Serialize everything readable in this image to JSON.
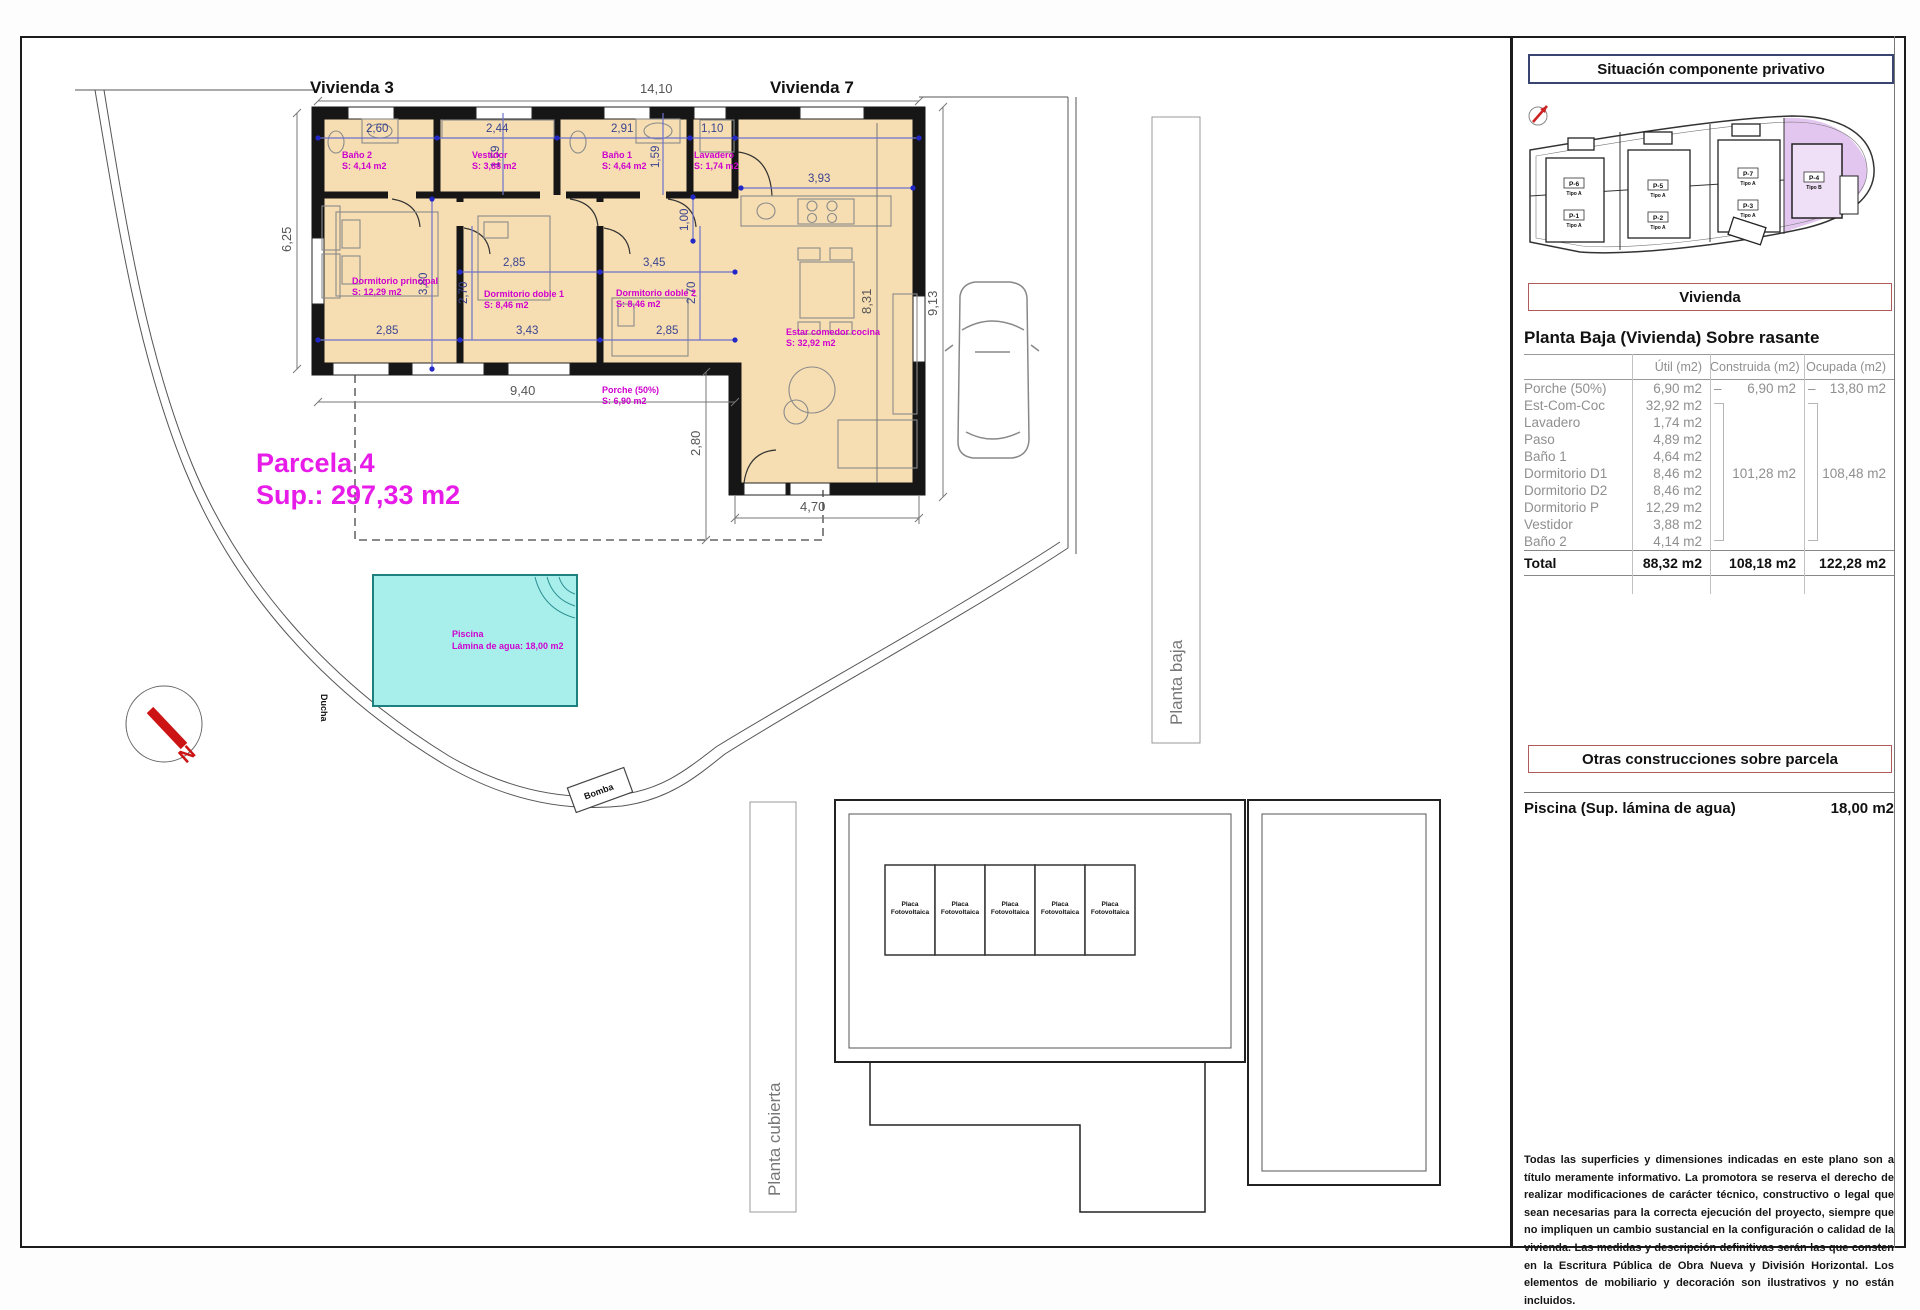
{
  "plan": {
    "labels": {
      "vivienda3": "Vivienda 3",
      "vivienda7": "Vivienda 7",
      "parcela": "Parcela 4",
      "parcela_sup": "Sup.: 297,33 m2",
      "piscina": "Piscina",
      "piscina_area": "Lámina de agua: 18,00 m2",
      "ducha": "Ducha",
      "bomba": "Bomba",
      "planta_baja": "Planta baja",
      "planta_cubierta": "Planta cubierta",
      "placa": "Placa",
      "fotovoltaica": "Fotovoltaica",
      "north": "N"
    },
    "rooms": [
      {
        "name": "Baño 2",
        "area": "S: 4,14 m2"
      },
      {
        "name": "Vestidor",
        "area": "S: 3,88 m2"
      },
      {
        "name": "Baño 1",
        "area": "S: 4,64 m2"
      },
      {
        "name": "Lavadero",
        "area": "S: 1,74 m2"
      },
      {
        "name": "Dormitorio principal",
        "area": "S: 12,29 m2"
      },
      {
        "name": "Dormitorio doble 1",
        "area": "S: 8,46 m2"
      },
      {
        "name": "Dormitorio doble 2",
        "area": "S: 8,46 m2"
      },
      {
        "name": "Estar comedor cocina",
        "area": "S: 32,92 m2"
      },
      {
        "name": "Porche (50%)",
        "area": "S: 6,90 m2"
      }
    ],
    "dims": {
      "top": "14,10",
      "w260": "2,60",
      "w244": "2,44",
      "w291": "2,91",
      "w110": "1,10",
      "h159a": "1,59",
      "h159b": "1,59",
      "h625": "6,25",
      "h380": "3,80",
      "w285a": "2,85",
      "w345": "3,45",
      "w285b": "2,85",
      "w343": "3,43",
      "w285c": "2,85",
      "h270a": "2,70",
      "h270b": "2,70",
      "h100": "1,00",
      "w393": "3,93",
      "h831": "8,31",
      "h913": "9,13",
      "w940": "9,40",
      "h280": "2,80",
      "w470": "4,70"
    }
  },
  "site": {
    "title": "Situación componente privativo",
    "plots": [
      {
        "id": "P-6",
        "tipo": "Tipo A"
      },
      {
        "id": "P-1",
        "tipo": "Tipo A"
      },
      {
        "id": "P-5",
        "tipo": "Tipo A"
      },
      {
        "id": "P-2",
        "tipo": "Tipo A"
      },
      {
        "id": "P-7",
        "tipo": "Tipo A"
      },
      {
        "id": "P-3",
        "tipo": "Tipo A"
      },
      {
        "id": "P-4",
        "tipo": "Tipo B"
      }
    ]
  },
  "vivienda": {
    "title": "Vivienda",
    "subtitle": "Planta Baja (Vivienda) Sobre rasante",
    "columns": [
      "Útil (m2)",
      "Construida (m2)",
      "Ocupada (m2)"
    ],
    "dash": "–",
    "rows": [
      {
        "name": "Porche (50%)",
        "util": "6,90 m2",
        "construida": "6,90 m2",
        "ocupada": "13,80 m2"
      },
      {
        "name": "Est-Com-Coc",
        "util": "32,92 m2"
      },
      {
        "name": "Lavadero",
        "util": "1,74 m2"
      },
      {
        "name": "Paso",
        "util": "4,89 m2"
      },
      {
        "name": "Baño 1",
        "util": "4,64 m2"
      },
      {
        "name": "Dormitorio D1",
        "util": "8,46 m2",
        "construida": "101,28 m2",
        "ocupada": "108,48 m2"
      },
      {
        "name": "Dormitorio D2",
        "util": "8,46 m2"
      },
      {
        "name": "Dormitorio P",
        "util": "12,29 m2"
      },
      {
        "name": "Vestidor",
        "util": "3,88 m2"
      },
      {
        "name": "Baño 2",
        "util": "4,14 m2"
      }
    ],
    "total": {
      "name": "Total",
      "util": "88,32 m2",
      "construida": "108,18 m2",
      "ocupada": "122,28 m2"
    }
  },
  "otras": {
    "title": "Otras construcciones sobre parcela",
    "item": "Piscina (Sup. lámina de agua)",
    "value": "18,00 m2"
  },
  "disclaimer": "Todas las superficies y dimensiones indicadas en este plano son a título meramente informativo. La promotora se reserva el derecho de realizar modificaciones de carácter técnico, constructivo o legal que sean necesarias para la correcta ejecución del proyecto, siempre que no impliquen un cambio sustancial en la configuración o calidad de la vivienda. Las medidas y descripción definitivas serán las que consten en la Escritura Pública de Obra Nueva y División Horizontal. Los elementos de mobiliario y decoración son ilustrativos y no están incluidos."
}
